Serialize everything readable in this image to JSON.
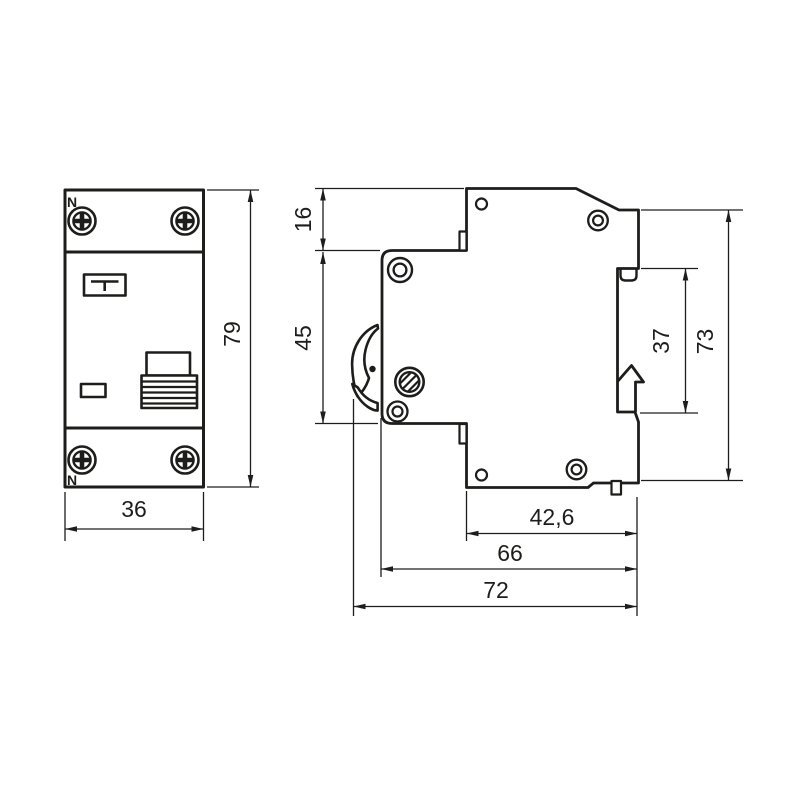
{
  "colors": {
    "line": "#1d1d1b",
    "background": "#ffffff"
  },
  "front_view": {
    "neutral_label_top": "N",
    "neutral_label_bottom": "N",
    "dim_width": "36",
    "dim_height": "79"
  },
  "side_view": {
    "dim_top_section": "16",
    "dim_front_face": "45",
    "dim_din_channel": "37",
    "dim_back_height": "73",
    "dim_rear_depth": "42,6",
    "dim_body_depth": "66",
    "dim_total_depth": "72"
  }
}
